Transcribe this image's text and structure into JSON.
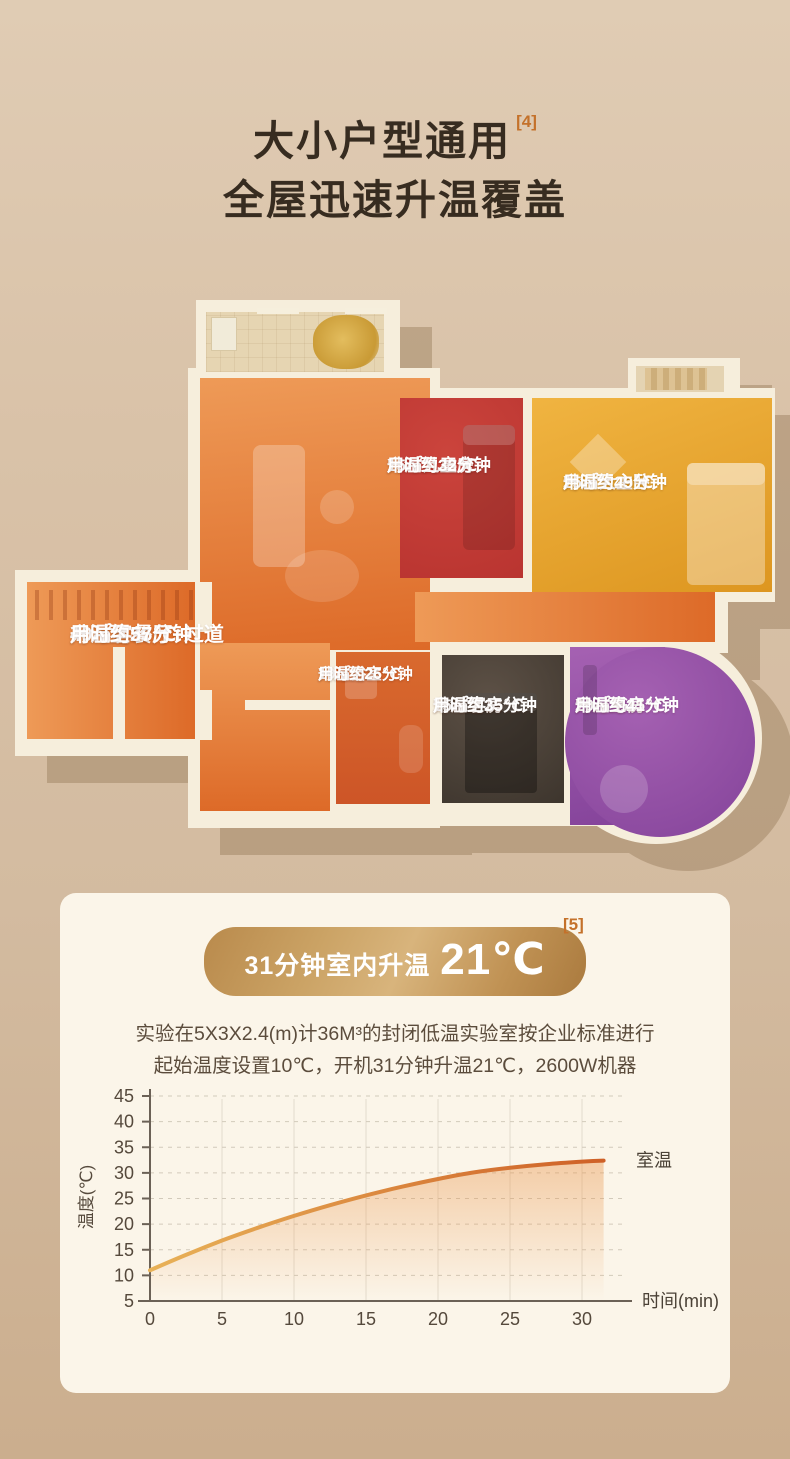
{
  "palette": {
    "page_bg": "#d8c1a7",
    "card_bg": "#fbf5e9",
    "wall": "#f6eedc",
    "footnote_color": "#c4712a",
    "badge_gold": "#c09254",
    "title_color": "#372c20",
    "plan_shadow": "rgba(148,118,86,0.42)"
  },
  "header": {
    "title_line1": "大小户型通用",
    "title_footnote": "[4]",
    "title_line2": "全屋迅速升温覆盖"
  },
  "floorplan": {
    "rooms": [
      {
        "id": "living",
        "name": "40㎡客餐厅+过道",
        "temp": "升温至25℃",
        "time": "用时约57分钟",
        "color_light": "#ee9a57",
        "color": "#dd6a28"
      },
      {
        "id": "kids",
        "name": "15㎡儿童房",
        "temp": "升温至25℃",
        "time": "用时约32分钟",
        "color_light": "#cb443c",
        "color": "#b93430"
      },
      {
        "id": "master",
        "name": "25㎡大主卧",
        "temp": "升温至25℃",
        "time": "用时约49分钟",
        "color_light": "#f0b441",
        "color": "#dd9620"
      },
      {
        "id": "bath",
        "name": "10㎡浴室",
        "temp": "升温至25℃",
        "time": "用时约26分钟",
        "color_light": "#d96a2e",
        "color": "#cd5527"
      },
      {
        "id": "guest",
        "name": "15㎡客房",
        "temp": "升温至25℃",
        "time": "用时约35分钟",
        "color_light": "#5d5146",
        "color": "#3d352d"
      },
      {
        "id": "study",
        "name": "20㎡书房",
        "temp": "升温至25℃",
        "time": "用时约41分钟",
        "color_light": "#a561b2",
        "color": "#84439a"
      }
    ]
  },
  "experiment": {
    "badge_prefix": "31分钟室内升温",
    "badge_value": "21℃",
    "badge_footnote": "[5]",
    "desc_line1": "实验在5X3X2.4(m)计36M³的封闭低温实验室按企业标准进行",
    "desc_line2": "起始温度设置10℃，开机31分钟升温21℃，2600W机器"
  },
  "chart_data": {
    "type": "line",
    "x": [
      0,
      2.5,
      5,
      7.5,
      10,
      12.5,
      15,
      17.5,
      20,
      22.5,
      25,
      27.5,
      30,
      31.5
    ],
    "y": [
      11,
      14,
      16.8,
      19.3,
      21.6,
      23.7,
      25.6,
      27.3,
      28.8,
      30.1,
      31,
      31.7,
      32.2,
      32.4
    ],
    "xticks": [
      0,
      5,
      10,
      15,
      20,
      25,
      30
    ],
    "yticks": [
      5,
      10,
      15,
      20,
      25,
      30,
      35,
      40,
      45
    ],
    "xlim": [
      0,
      32
    ],
    "ylim": [
      5,
      45
    ],
    "xlabel": "时间(min)",
    "ylabel": "温度(℃)",
    "series_label": "室温",
    "line_color_start": "#e8b258",
    "line_color_end": "#ce5f26",
    "grid": "horizontal-dashed, vertical-solid",
    "legend_position": "right-of-line-end"
  }
}
